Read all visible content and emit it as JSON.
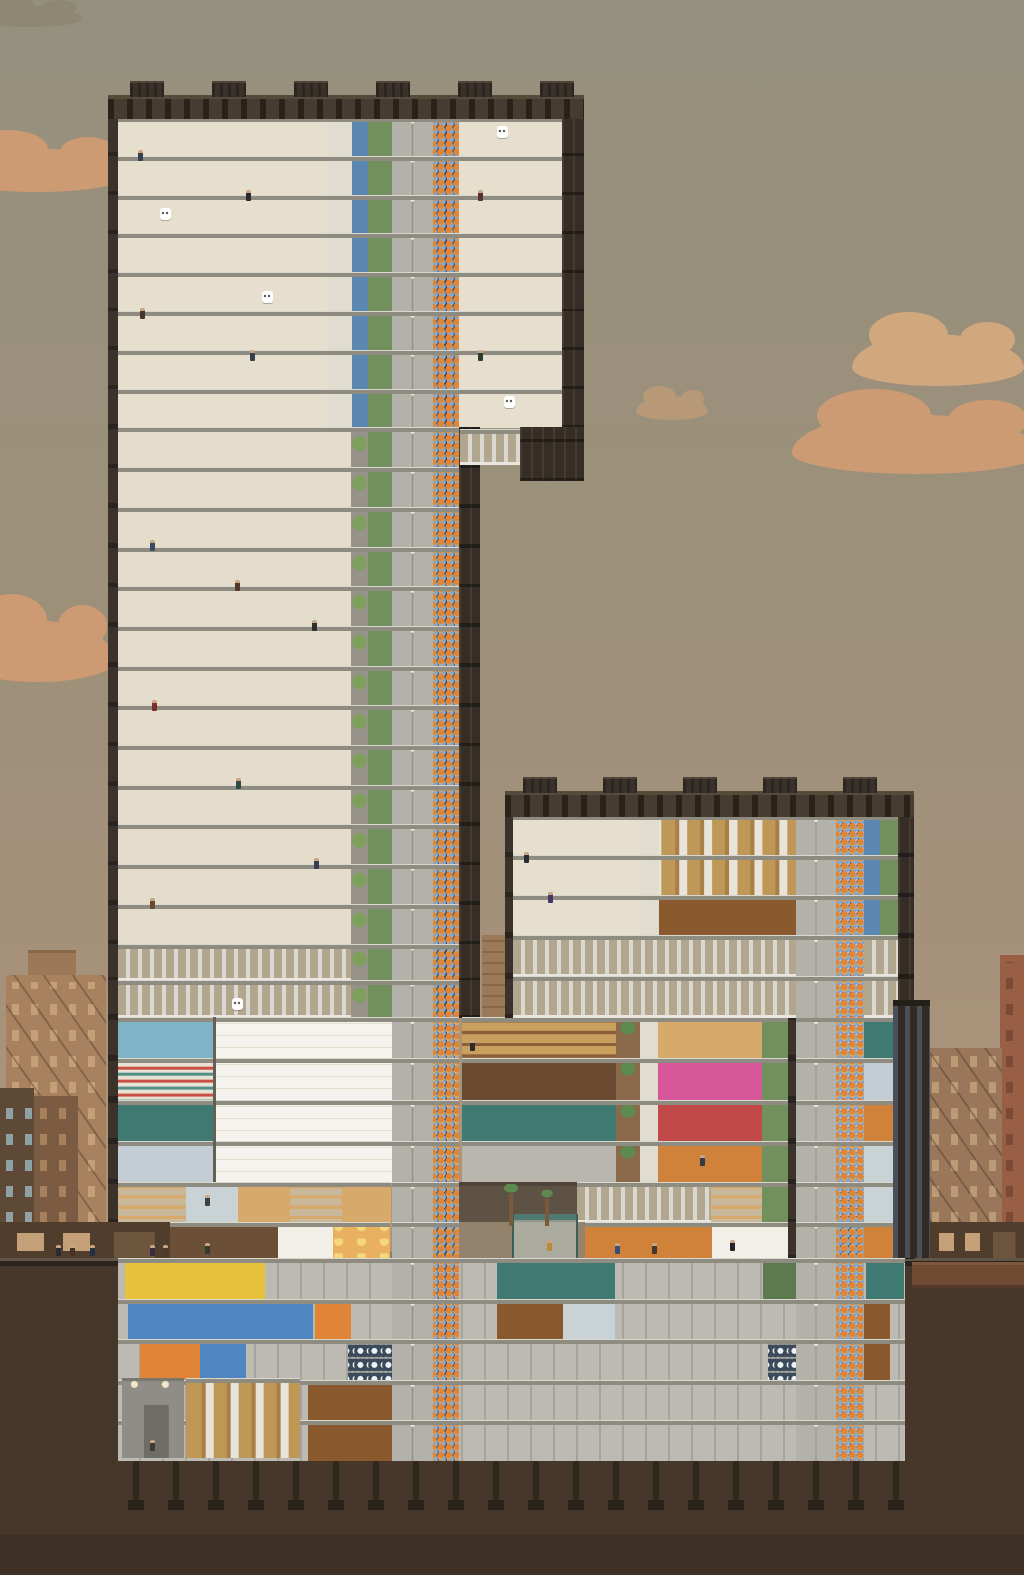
{
  "meta": {
    "scene": "high-rise tower simulation, side cross-section view",
    "hud_visible": false
  },
  "palette": {
    "sky_top": "#95907e",
    "sky_bottom": "#ad9579",
    "cloud_salmon": "#cf9b73",
    "cloud_warm": "#d4a87f",
    "earth": "#46372a",
    "sidewalk": "#8a7e6d",
    "road": "#2c241c",
    "frame_brown": "#3b332b",
    "facade_dark": "#362e26",
    "roof_crown": "#463c30",
    "apartment_orange": "#c2693a",
    "slab_gray": "#8e8b81",
    "corridor_white": "#efede4",
    "elevator_gray": "#c6c5bf",
    "riser_dark": "#62625c",
    "trash_green": "#9cb885",
    "mech_louver": "#b2a78e",
    "retail_teal": "#3e6a60",
    "diner_pink": "#d8569a",
    "workshop_orange": "#cf7e2e",
    "basement_gray": "#bcbab2",
    "riser_dots": [
      "#ecc94c",
      "#e08438",
      "#7aa6d6",
      "#eab2cc",
      "#b79ade",
      "#7ec4b8"
    ]
  },
  "building_summary": {
    "top_block_apartment_floors": 8,
    "studio_floors": 13,
    "left_mechanical_floors": 2,
    "retail_floors": 4,
    "restaurant_floors": 1,
    "ground_floor": 1,
    "basement_levels": 5,
    "right_tower_apartment_floors": 3,
    "right_tower_mechanical_floors": 2,
    "foundation_piles": 20
  },
  "clouds": [
    [
      -50,
      148,
      175,
      44,
      "#cf9b73"
    ],
    [
      -40,
      620,
      155,
      62,
      "#cf9b73"
    ],
    [
      852,
      334,
      172,
      52,
      "#d4a87f"
    ],
    [
      792,
      414,
      248,
      60,
      "#cf9b73"
    ],
    [
      -28,
      5,
      110,
      22,
      "#8e8872"
    ],
    [
      636,
      396,
      72,
      24,
      "#b99a77"
    ]
  ],
  "bg_buildings": [
    [
      6,
      975,
      100,
      283,
      "#a8825f",
      "#c3a078",
      true
    ],
    [
      0,
      1088,
      34,
      170,
      "#5e4936",
      "#8fa1a4",
      false
    ],
    [
      34,
      1096,
      44,
      162,
      "#7b5b41",
      "#a9805c",
      false
    ],
    [
      1000,
      955,
      24,
      303,
      "#995f45",
      "#7a4a36",
      false
    ],
    [
      926,
      1048,
      76,
      210,
      "#9a775a",
      "#bb9a76",
      true
    ],
    [
      906,
      1105,
      22,
      153,
      "#81624a",
      "#9a7a58",
      false
    ]
  ],
  "ground": {
    "sidewalk_y": 1250,
    "earth_y": 1259
  },
  "piles": {
    "x0": 133,
    "x1": 896,
    "step": 40,
    "y": 1460,
    "h": 48
  },
  "sections": [
    {
      "name": "top-apartment-block",
      "y": 117,
      "rh": 38.8,
      "rows": 8,
      "cells": [
        [
          "wall",
          108,
          10
        ],
        [
          "aliv",
          118,
          54
        ],
        [
          "abed",
          172,
          51
        ],
        [
          "aliv",
          223,
          53
        ],
        [
          "abed",
          276,
          51
        ],
        [
          "hallp",
          327,
          25
        ],
        [
          "utilb",
          352,
          16
        ],
        [
          "trash",
          368,
          24
        ],
        [
          "elevator",
          392,
          41
        ],
        [
          "riser",
          433,
          26
        ],
        [
          "aliv",
          459,
          52
        ],
        [
          "abed",
          511,
          51
        ],
        [
          "wallx",
          562,
          22
        ]
      ]
    },
    {
      "name": "studio-tower",
      "y": 427.4,
      "rh": 39.7,
      "rows": 13,
      "cells": [
        [
          "wall",
          108,
          10
        ],
        [
          "studio",
          118,
          79
        ],
        [
          "studio",
          197,
          78
        ],
        [
          "studio",
          275,
          76
        ],
        [
          "hall",
          351,
          17
        ],
        [
          "trash",
          368,
          24
        ],
        [
          "elevator",
          392,
          41
        ],
        [
          "riser",
          433,
          26
        ],
        [
          "wallx",
          459,
          21
        ]
      ]
    },
    {
      "name": "left-mechanical",
      "y": 943.5,
      "rh": 36.8,
      "rows": 2,
      "cells": [
        [
          "wall",
          108,
          10
        ],
        [
          "mech",
          118,
          233
        ],
        [
          "hall",
          351,
          17
        ],
        [
          "trash",
          368,
          24
        ],
        [
          "elevator",
          392,
          41
        ],
        [
          "riser",
          433,
          26
        ],
        [
          "wallx",
          459,
          21
        ]
      ]
    },
    {
      "name": "retail-bridge",
      "y": 1017.1,
      "rh": 41.3,
      "rows": 4,
      "cells": [
        [
          "wall",
          108,
          10
        ],
        [
          [
            "medical",
            "pharmacy",
            "vending",
            "lab"
          ],
          118,
          95
        ],
        [
          "empty",
          213,
          179
        ],
        [
          "elevator",
          392,
          41
        ],
        [
          "riser",
          433,
          26
        ],
        [
          [
            "bagshop",
            "boutique",
            "waiting",
            "appliance"
          ],
          462,
          154
        ],
        [
          "palmcell",
          616,
          24
        ],
        [
          "hallp",
          640,
          18
        ],
        [
          [
            "bar-teal",
            "diner-pink",
            "diner-red",
            "cafe-orange"
          ],
          658,
          104
        ],
        [
          "trash",
          762,
          26
        ],
        [
          "wall",
          788,
          8
        ],
        [
          "elevator",
          796,
          40
        ],
        [
          "riser",
          836,
          28
        ],
        [
          [
            "vending",
            "lab",
            "office-small",
            "kitchen-teal"
          ],
          864,
          34
        ],
        [
          "wallx",
          898,
          16
        ]
      ]
    },
    {
      "name": "restaurant-floor",
      "y": 1182.3,
      "rh": 40,
      "rows": 1,
      "cells": [
        [
          "wall",
          108,
          10
        ],
        [
          "store-teal",
          118,
          68
        ],
        [
          "kitchen-teal",
          186,
          52
        ],
        [
          "bar-teal",
          238,
          52
        ],
        [
          "store-teal",
          290,
          52
        ],
        [
          "bar-teal",
          342,
          49
        ],
        [
          "elevator",
          392,
          41
        ],
        [
          "riser",
          433,
          26
        ],
        [
          "shadow",
          459,
          118
        ],
        [
          "mech",
          577,
          134
        ],
        [
          "store-teal",
          711,
          51
        ],
        [
          "trash",
          762,
          26
        ],
        [
          "wall",
          788,
          8
        ],
        [
          "elevator",
          796,
          40
        ],
        [
          "riser",
          836,
          28
        ],
        [
          "kitchen-teal",
          864,
          34
        ],
        [
          "wallx",
          898,
          16
        ]
      ]
    },
    {
      "name": "ground-floor",
      "y": 1222.3,
      "rh": 36,
      "rows": 1,
      "cells": [
        [
          "lobby",
          170,
          108
        ],
        [
          "hallw",
          278,
          55
        ],
        [
          "barber",
          333,
          57
        ],
        [
          "elevator",
          392,
          41
        ],
        [
          "riser",
          433,
          26
        ],
        [
          "plaza",
          459,
          126
        ],
        [
          "office",
          585,
          127
        ],
        [
          "hallw",
          712,
          76
        ],
        [
          "wall",
          788,
          8
        ],
        [
          "elevator",
          796,
          40
        ],
        [
          "riser",
          836,
          28
        ],
        [
          "office-small",
          864,
          34
        ],
        [
          "wallx",
          898,
          16
        ]
      ]
    },
    {
      "name": "basements",
      "y": 1258.3,
      "rh": 40.4,
      "rows": 5,
      "rowsCells": [
        [
          [
            "bpanel",
            118,
            787
          ],
          [
            "elec",
            125,
            140
          ],
          [
            "break",
            497,
            118
          ],
          [
            "btrash",
            763,
            50
          ],
          [
            "vending",
            866,
            38
          ],
          [
            "elevator",
            392,
            41
          ],
          [
            "riser",
            433,
            26
          ],
          [
            "elevator",
            796,
            40
          ],
          [
            "riser",
            836,
            28
          ]
        ],
        [
          [
            "bpanel",
            118,
            787
          ],
          [
            "water",
            128,
            95
          ],
          [
            "water",
            223,
            90
          ],
          [
            "heat",
            315,
            36
          ],
          [
            "workshop",
            497,
            66
          ],
          [
            "kitchen-teal",
            563,
            52
          ],
          [
            "workshop",
            828,
            62
          ],
          [
            "elevator",
            392,
            41
          ],
          [
            "riser",
            433,
            26
          ],
          [
            "elevator",
            796,
            40
          ],
          [
            "riser",
            836,
            28
          ]
        ],
        [
          [
            "bpanel",
            118,
            787
          ],
          [
            "heat",
            140,
            60
          ],
          [
            "water",
            200,
            46
          ],
          [
            "laundry",
            348,
            44
          ],
          [
            "laundry",
            768,
            44
          ],
          [
            "workshop",
            828,
            62
          ],
          [
            "elevator",
            392,
            41
          ],
          [
            "riser",
            433,
            26
          ],
          [
            "elevator",
            796,
            40
          ],
          [
            "riser",
            836,
            28
          ]
        ],
        [
          [
            "bpanel",
            118,
            787
          ],
          [
            "workshop",
            308,
            84
          ],
          [
            "elevator",
            392,
            41
          ],
          [
            "riser",
            433,
            26
          ],
          [
            "elevator",
            796,
            40
          ],
          [
            "riser",
            836,
            28
          ]
        ],
        [
          [
            "bpanel",
            118,
            787
          ],
          [
            "workshop",
            308,
            84
          ],
          [
            "elevator",
            392,
            41
          ],
          [
            "riser",
            433,
            26
          ],
          [
            "elevator",
            796,
            40
          ],
          [
            "riser",
            836,
            28
          ]
        ]
      ]
    },
    {
      "name": "right-tower-apartments",
      "y": 815,
      "rh": 40,
      "rows": 3,
      "cells": [
        [
          "wall",
          505,
          8
        ],
        [
          "aliv",
          513,
          63
        ],
        [
          "abed",
          576,
          65
        ],
        [
          "hallp",
          641,
          18
        ],
        [
          [
            "crates",
            "crates",
            "workshop"
          ],
          659,
          137
        ],
        [
          "elevator",
          796,
          40
        ],
        [
          "riser",
          836,
          28
        ],
        [
          "utilb",
          864,
          16
        ],
        [
          "trash",
          880,
          18
        ],
        [
          "wallx",
          898,
          16
        ]
      ]
    },
    {
      "name": "right-tower-mechanical",
      "y": 935,
      "rh": 41,
      "rows": 2,
      "cells": [
        [
          "wall",
          505,
          8
        ],
        [
          "mech",
          513,
          283
        ],
        [
          "elevator",
          796,
          40
        ],
        [
          "riser",
          836,
          28
        ],
        [
          "mech",
          864,
          34
        ],
        [
          "wallx",
          898,
          16
        ]
      ]
    }
  ],
  "structures": [
    [
      "roof",
      108,
      95,
      476,
      24
    ],
    [
      "roof",
      505,
      791,
      409,
      26
    ],
    [
      "mech",
      460,
      429,
      60,
      36
    ],
    [
      "wallx",
      520,
      427,
      64,
      54
    ],
    [
      "brick",
      482,
      935,
      23,
      82
    ],
    [
      "annex",
      893,
      1000,
      37,
      258
    ],
    [
      "dock",
      122,
      1378,
      62,
      80
    ],
    [
      "crates",
      186,
      1378,
      114,
      80
    ],
    [
      "storefront",
      0,
      1222,
      170,
      36
    ],
    [
      "storefront",
      930,
      1222,
      94,
      36
    ],
    [
      "bgroof",
      28,
      950,
      48,
      25
    ],
    [
      "shelter",
      512,
      1214,
      66,
      44
    ],
    [
      "palmtree",
      500,
      1184,
      22,
      42
    ],
    [
      "palmtree",
      538,
      1190,
      18,
      36
    ]
  ],
  "rooftop_units": [
    [
      130,
      81
    ],
    [
      212,
      81
    ],
    [
      294,
      81
    ],
    [
      376,
      81
    ],
    [
      458,
      81
    ],
    [
      540,
      81
    ],
    [
      523,
      777
    ],
    [
      603,
      777
    ],
    [
      683,
      777
    ],
    [
      763,
      777
    ],
    [
      843,
      777
    ]
  ],
  "people": [
    [
      56,
      1245,
      "#2b2b38"
    ],
    [
      70,
      1245,
      "#463227"
    ],
    [
      90,
      1245,
      "#263243"
    ],
    [
      150,
      1245,
      "#3c2b3e"
    ],
    [
      163,
      1245,
      "#50392b"
    ],
    [
      205,
      1243,
      "#333a2e"
    ],
    [
      615,
      1243,
      "#374f76"
    ],
    [
      652,
      1243,
      "#44362a"
    ],
    [
      730,
      1240,
      "#23242a"
    ],
    [
      547,
      1240,
      "#b98a3a"
    ],
    [
      150,
      540,
      "#3a4a62"
    ],
    [
      235,
      580,
      "#50392b"
    ],
    [
      312,
      620,
      "#2e2e2e"
    ],
    [
      152,
      700,
      "#7a2f2f"
    ],
    [
      236,
      778,
      "#2f4a3e"
    ],
    [
      314,
      858,
      "#3a3a52"
    ],
    [
      150,
      898,
      "#6b4a2e"
    ],
    [
      138,
      150,
      "#33414f"
    ],
    [
      246,
      190,
      "#2b2b2b"
    ],
    [
      478,
      190,
      "#5a3030"
    ],
    [
      140,
      308,
      "#46362b"
    ],
    [
      250,
      350,
      "#33414f"
    ],
    [
      478,
      350,
      "#2f3f2f"
    ],
    [
      524,
      852,
      "#2b2b38"
    ],
    [
      548,
      892,
      "#463763"
    ],
    [
      470,
      1040,
      "#2b2b2b"
    ],
    [
      700,
      1155,
      "#343b45"
    ],
    [
      205,
      1195,
      "#3f3f3f"
    ],
    [
      150,
      1440,
      "#3c3c34"
    ]
  ],
  "speech_bubbles": [
    [
      497,
      126
    ],
    [
      160,
      208
    ],
    [
      262,
      291
    ],
    [
      504,
      396
    ],
    [
      232,
      998
    ]
  ]
}
